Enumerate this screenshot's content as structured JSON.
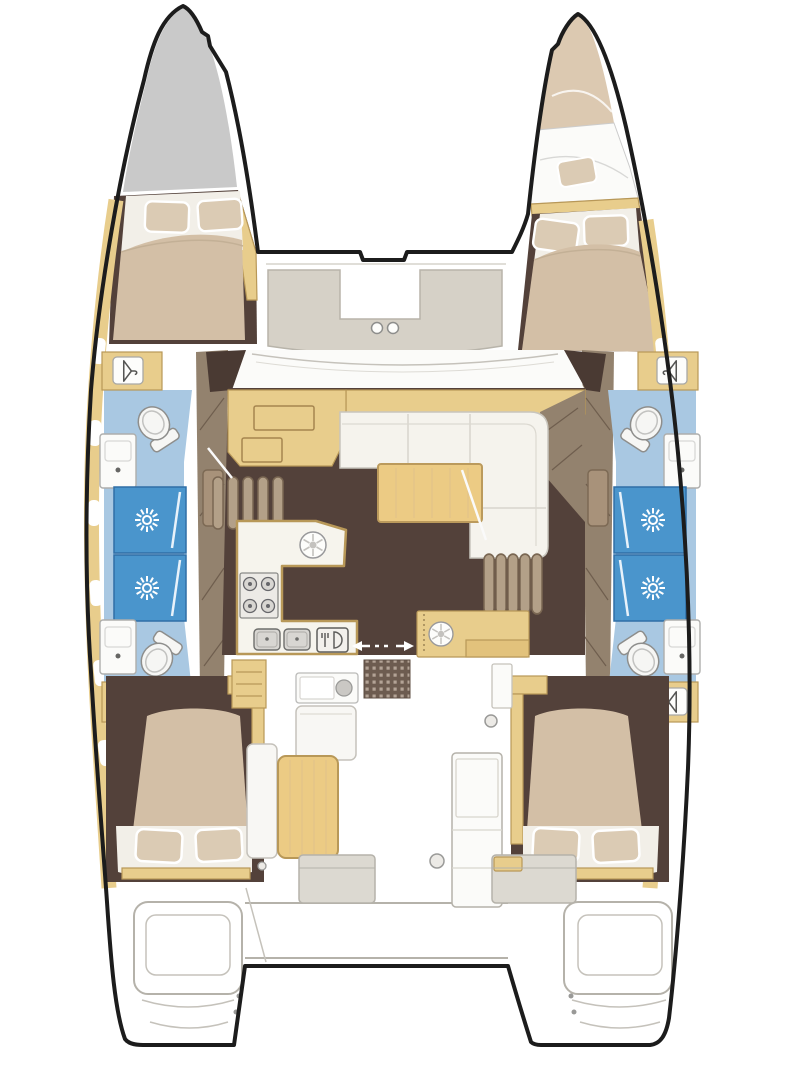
{
  "meta": {
    "title": "Catamaran interior layout floor plan (top-down view)",
    "type": "floor-plan"
  },
  "palette": {
    "outline": "#1c1c1c",
    "bow-gray": "#c9c9c9",
    "wood": "#e8cd8c",
    "wood-dark": "#b89858",
    "table-wood": "#eccb84",
    "floor-brown": "#53413a",
    "floor-deep": "#4a3a33",
    "taupe": "#93826e",
    "taupe-light": "#d6d1c7",
    "mattress": "#d3bfa6",
    "pillow": "#dbcbb4",
    "sheet": "#f2efe8",
    "bath-blue": "#a9c8e2",
    "shower-blue": "#4a95cc",
    "sofa": "#f5f3ed",
    "line-gray": "#b5b2aa",
    "bed-tan": "#dcc9b1"
  },
  "areas": {
    "port_hull": {
      "label": "Port hull"
    },
    "starboard_hull": {
      "label": "Starboard hull"
    },
    "bow_locker": {
      "label": "Port bow locker (gray deck)"
    },
    "forepeak_berth": {
      "label": "Starboard forepeak berth with pillow"
    },
    "port_forward_cabin": {
      "label": "Port forward cabin - double berth, pillows forward"
    },
    "starboard_forward_cabin": {
      "label": "Starboard forward cabin - double berth, pillows forward"
    },
    "port_aft_cabin": {
      "label": "Port aft cabin - double berth, pillows aft"
    },
    "starboard_aft_cabin": {
      "label": "Starboard aft cabin - double berth, pillows aft"
    },
    "port_forward_bathroom": {
      "label": "Port forward bathroom",
      "fixtures": [
        "toilet",
        "washbasin",
        "shower"
      ]
    },
    "port_aft_bathroom": {
      "label": "Port aft bathroom",
      "fixtures": [
        "shower",
        "washbasin",
        "toilet"
      ]
    },
    "starboard_forward_bathroom": {
      "label": "Starboard forward bathroom",
      "fixtures": [
        "toilet",
        "washbasin",
        "shower"
      ]
    },
    "starboard_aft_bathroom": {
      "label": "Starboard aft bathroom",
      "fixtures": [
        "shower",
        "washbasin",
        "toilet"
      ]
    },
    "foredeck_seating": {
      "label": "Forward cockpit U-shaped seating",
      "cupholders": 2
    },
    "windshield": {
      "label": "Coachroof windshield"
    },
    "saloon": {
      "label": "Saloon"
    },
    "nav_station": {
      "label": "Navigation station desk"
    },
    "sofa": {
      "label": "L-shaped saloon sofa"
    },
    "dining_table": {
      "label": "Saloon dining table"
    },
    "galley": {
      "label": "G-shaped galley",
      "hob_burners": 4,
      "round_sinks": 2,
      "twin_sink_bowls": 2,
      "appliance": "dishwasher drawer"
    },
    "port_stairs": {
      "label": "Port companionway stairs",
      "steps": 5
    },
    "starboard_stairs": {
      "label": "Starboard companionway stairs",
      "steps": 5
    },
    "aft_galley_cabinet": {
      "label": "Aft galley cabinet with round sink"
    },
    "sliding_door": {
      "label": "Sliding door to cockpit (double arrows)"
    },
    "cockpit": {
      "label": "Aft cockpit"
    },
    "cockpit_grating": {
      "label": "Cockpit teak grating"
    },
    "cockpit_table": {
      "label": "Cockpit table"
    },
    "helm_module": {
      "label": "Helm / cockpit module"
    },
    "aft_bench": {
      "label": "Aft cockpit bench, split with central passage"
    },
    "port_swim_platform": {
      "label": "Port transom swim steps"
    },
    "starboard_swim_platform": {
      "label": "Starboard transom swim steps"
    }
  },
  "icons": [
    {
      "name": "shower-head-icon",
      "meaning": "shower stall sunburst head"
    },
    {
      "name": "toilet-icon",
      "meaning": "marine toilet"
    },
    {
      "name": "washbasin-icon",
      "meaning": "bathroom washbasin with drain"
    },
    {
      "name": "hanger-icon",
      "meaning": "hanging locker / wardrobe"
    },
    {
      "name": "burner-icon",
      "meaning": "galley hob burner"
    },
    {
      "name": "round-sink-icon",
      "meaning": "round sink with strainer"
    },
    {
      "name": "cupholder-icon",
      "meaning": "foredeck seat cupholder"
    },
    {
      "name": "sliding-door-arrows-icon",
      "meaning": "sliding door opening direction"
    },
    {
      "name": "pillow-icon",
      "meaning": "berth pillow"
    }
  ]
}
